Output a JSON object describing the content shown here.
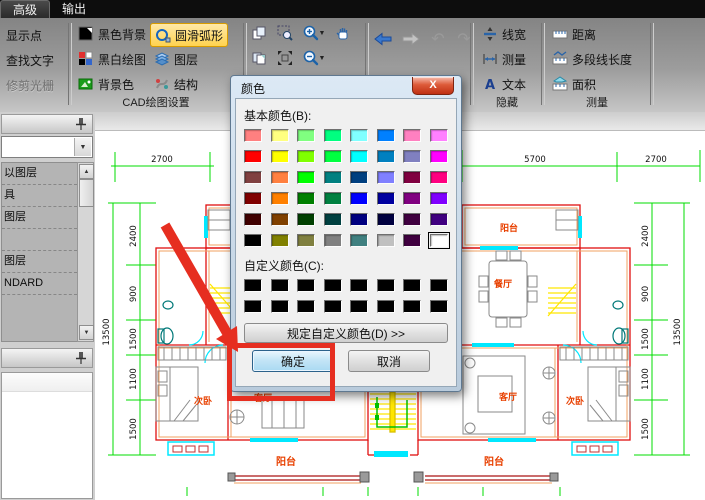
{
  "menu_bar": {
    "tabs": [
      "高级",
      "输出"
    ]
  },
  "ribbon": {
    "left_buttons": [
      "显示点",
      "查找文字",
      "修剪光栅"
    ],
    "cad_group": {
      "label": "CAD绘图设置",
      "col1": [
        "黑色背景",
        "黑白绘图",
        "背景色"
      ],
      "col2": [
        "圆滑弧形",
        "图层",
        "结构"
      ],
      "highlighted": "圆滑弧形",
      "highlight_color": "#ffd34f"
    },
    "nav": {
      "undo_glyph": "↶",
      "redo_glyph": "↷"
    },
    "hide_group": {
      "label": "隐藏",
      "items": [
        "线宽",
        "测量",
        "文本"
      ]
    },
    "measure_group": {
      "label": "测量",
      "items": [
        "距离",
        "多段线长度",
        "面积"
      ]
    }
  },
  "sidebar": {
    "combo_value": "",
    "combo_caret": "▼",
    "scroll_up": "▲",
    "scroll_down": "▼",
    "items": [
      "以图层",
      "具",
      "图层",
      "",
      "图层",
      "NDARD"
    ]
  },
  "dialog": {
    "title": "颜色",
    "close_glyph": "X",
    "basic_label": "基本颜色(B):",
    "custom_label": "自定义颜色(C):",
    "define_button": "规定自定义颜色(D) >>",
    "ok_button": "确定",
    "cancel_button": "取消",
    "selected_index": 47,
    "selected_color": "#FFFFFF",
    "basic_colors": [
      "#FF8080",
      "#FFFF80",
      "#80FF80",
      "#00FF80",
      "#80FFFF",
      "#0080FF",
      "#FF80C0",
      "#FF80FF",
      "#FF0000",
      "#FFFF00",
      "#80FF00",
      "#00FF40",
      "#00FFFF",
      "#0080C0",
      "#8080C0",
      "#FF00FF",
      "#804040",
      "#FF8040",
      "#00FF00",
      "#008080",
      "#004080",
      "#8080FF",
      "#800040",
      "#FF0080",
      "#800000",
      "#FF8000",
      "#008000",
      "#008040",
      "#0000FF",
      "#0000A0",
      "#800080",
      "#8000FF",
      "#400000",
      "#804000",
      "#004000",
      "#004040",
      "#000080",
      "#000040",
      "#400040",
      "#400080",
      "#000000",
      "#808000",
      "#808040",
      "#808080",
      "#408080",
      "#C0C0C0",
      "#400040",
      "#FFFFFF"
    ],
    "custom_colors": [
      "#000000",
      "#000000",
      "#000000",
      "#000000",
      "#000000",
      "#000000",
      "#000000",
      "#000000",
      "#000000",
      "#000000",
      "#000000",
      "#000000",
      "#000000",
      "#000000",
      "#000000",
      "#000000"
    ]
  },
  "canvas": {
    "rooms": {
      "balcony_top_right": "阳台",
      "balcony_top_left": "阳台",
      "dining": "餐厅",
      "living_right": "客厅",
      "bedroom_right": "次卧",
      "living_left": "客厅",
      "bedroom_left": "次卧",
      "balcony_bottom_left": "阳台",
      "balcony_bottom_right": "阳台"
    },
    "dims": {
      "top": [
        "2700",
        "5700",
        "2700"
      ],
      "left": [
        "2400",
        "900",
        "1500",
        "1100",
        "1500"
      ],
      "left_total": "13500",
      "right": [
        "2400",
        "900",
        "1500",
        "1100",
        "1500"
      ],
      "right_total": "13500"
    },
    "colors": {
      "dimension": "#00dd00",
      "wall": "#e01010",
      "wall_inner": "#f0a060",
      "window": "#00e8ff",
      "stairs": "#ffe600",
      "furniture": "#8a8a8a",
      "fixture": "#007878",
      "room_label": "#e84000"
    }
  },
  "annotation": {
    "color": "#e62e20"
  }
}
